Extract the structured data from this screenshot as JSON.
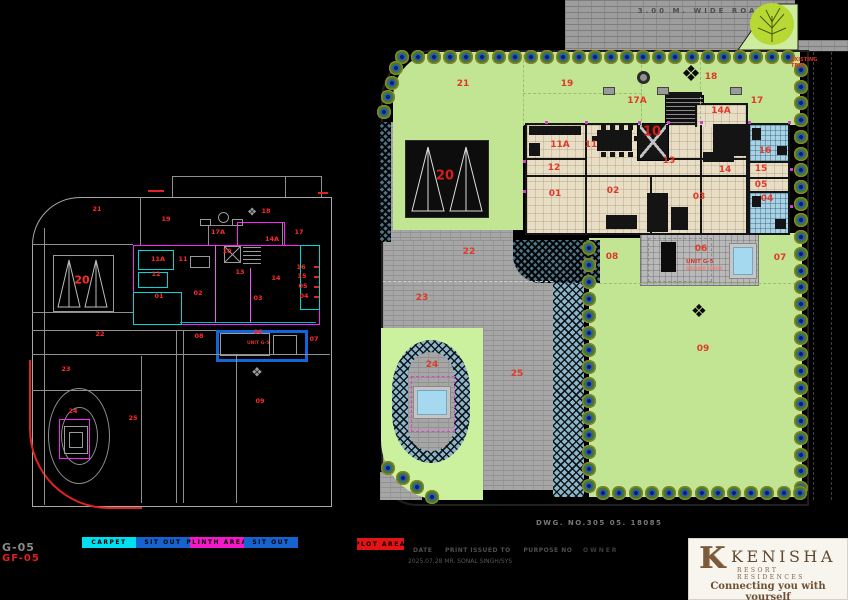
{
  "road": {
    "label": "3.00 M.  WIDE ROAD"
  },
  "side_note": {
    "line1": "EXISTING",
    "line2": "TREE"
  },
  "site_plan": {
    "unit_label": "UNIT G-5",
    "unit_sub": "GROUND FLOOR",
    "labels": [
      {
        "t": "21",
        "x": 463,
        "y": 84
      },
      {
        "t": "19",
        "x": 567,
        "y": 84
      },
      {
        "t": "17A",
        "x": 637,
        "y": 101
      },
      {
        "t": "18",
        "x": 711,
        "y": 77
      },
      {
        "t": "17",
        "x": 757,
        "y": 101
      },
      {
        "t": "14A",
        "x": 721,
        "y": 111
      },
      {
        "t": "11A",
        "x": 560,
        "y": 145
      },
      {
        "t": "11",
        "x": 591,
        "y": 145
      },
      {
        "t": "12",
        "x": 554,
        "y": 168
      },
      {
        "t": "10",
        "x": 652,
        "y": 132,
        "big": true
      },
      {
        "t": "13",
        "x": 669,
        "y": 161
      },
      {
        "t": "14",
        "x": 725,
        "y": 170
      },
      {
        "t": "16",
        "x": 765,
        "y": 151
      },
      {
        "t": "15",
        "x": 761,
        "y": 169
      },
      {
        "t": "05",
        "x": 761,
        "y": 185
      },
      {
        "t": "04",
        "x": 767,
        "y": 199
      },
      {
        "t": "01",
        "x": 555,
        "y": 194
      },
      {
        "t": "02",
        "x": 613,
        "y": 191
      },
      {
        "t": "03",
        "x": 699,
        "y": 197
      },
      {
        "t": "20",
        "x": 445,
        "y": 176,
        "big": true
      },
      {
        "t": "22",
        "x": 469,
        "y": 252
      },
      {
        "t": "23",
        "x": 422,
        "y": 298
      },
      {
        "t": "24",
        "x": 432,
        "y": 365
      },
      {
        "t": "25",
        "x": 517,
        "y": 374
      },
      {
        "t": "08",
        "x": 612,
        "y": 257
      },
      {
        "t": "06",
        "x": 701,
        "y": 249
      },
      {
        "t": "07",
        "x": 780,
        "y": 258
      },
      {
        "t": "09",
        "x": 703,
        "y": 349
      }
    ]
  },
  "cad_plan": {
    "unit_label": "UNIT G-5",
    "labels": [
      {
        "t": "21",
        "x": 97,
        "y": 209
      },
      {
        "t": "19",
        "x": 166,
        "y": 219
      },
      {
        "t": "18",
        "x": 266,
        "y": 211
      },
      {
        "t": "17A",
        "x": 218,
        "y": 232
      },
      {
        "t": "17",
        "x": 299,
        "y": 232
      },
      {
        "t": "14A",
        "x": 272,
        "y": 239
      },
      {
        "t": "11A",
        "x": 158,
        "y": 259
      },
      {
        "t": "11",
        "x": 183,
        "y": 259
      },
      {
        "t": "12",
        "x": 156,
        "y": 274
      },
      {
        "t": "10",
        "x": 227,
        "y": 251
      },
      {
        "t": "13",
        "x": 240,
        "y": 272
      },
      {
        "t": "14",
        "x": 276,
        "y": 278
      },
      {
        "t": "16",
        "x": 301,
        "y": 267
      },
      {
        "t": "15",
        "x": 302,
        "y": 276
      },
      {
        "t": "05",
        "x": 303,
        "y": 286
      },
      {
        "t": "04",
        "x": 304,
        "y": 296
      },
      {
        "t": "01",
        "x": 159,
        "y": 296
      },
      {
        "t": "02",
        "x": 198,
        "y": 293
      },
      {
        "t": "03",
        "x": 258,
        "y": 298
      },
      {
        "t": "20",
        "x": 82,
        "y": 280,
        "big": true
      },
      {
        "t": "22",
        "x": 100,
        "y": 334
      },
      {
        "t": "08",
        "x": 199,
        "y": 336
      },
      {
        "t": "06",
        "x": 258,
        "y": 332
      },
      {
        "t": "07",
        "x": 314,
        "y": 339
      },
      {
        "t": "23",
        "x": 66,
        "y": 369
      },
      {
        "t": "24",
        "x": 73,
        "y": 411
      },
      {
        "t": "25",
        "x": 133,
        "y": 418
      },
      {
        "t": "09",
        "x": 260,
        "y": 401
      }
    ]
  },
  "legend": {
    "items": [
      {
        "label": "CARPET",
        "color": "#00dff0"
      },
      {
        "label": "SIT OUT",
        "color": "#1663cf"
      },
      {
        "label": "PLINTH AREA",
        "color": "#f318c8"
      },
      {
        "label": "SIT OUT",
        "color": "#1663cf"
      }
    ],
    "plot": {
      "label": "PLOT AREA",
      "color": "#e51414"
    }
  },
  "titleblock": {
    "dwg_no": "DWG. NO.305 05. 18085",
    "f1": "DATE",
    "f2": "PRINT ISSUED TO",
    "f3": "PURPOSE NO",
    "owner": "OWNER",
    "issue": "2025.07.28 MR. SONAL SINGH/SYS",
    "sheet": "G-05",
    "sheet_red": "GF-05"
  },
  "logo": {
    "monogram": "K",
    "name": "KENISHA",
    "subtitle": "RESORT RESIDENCES",
    "tagline": "Connecting you with yourself"
  }
}
